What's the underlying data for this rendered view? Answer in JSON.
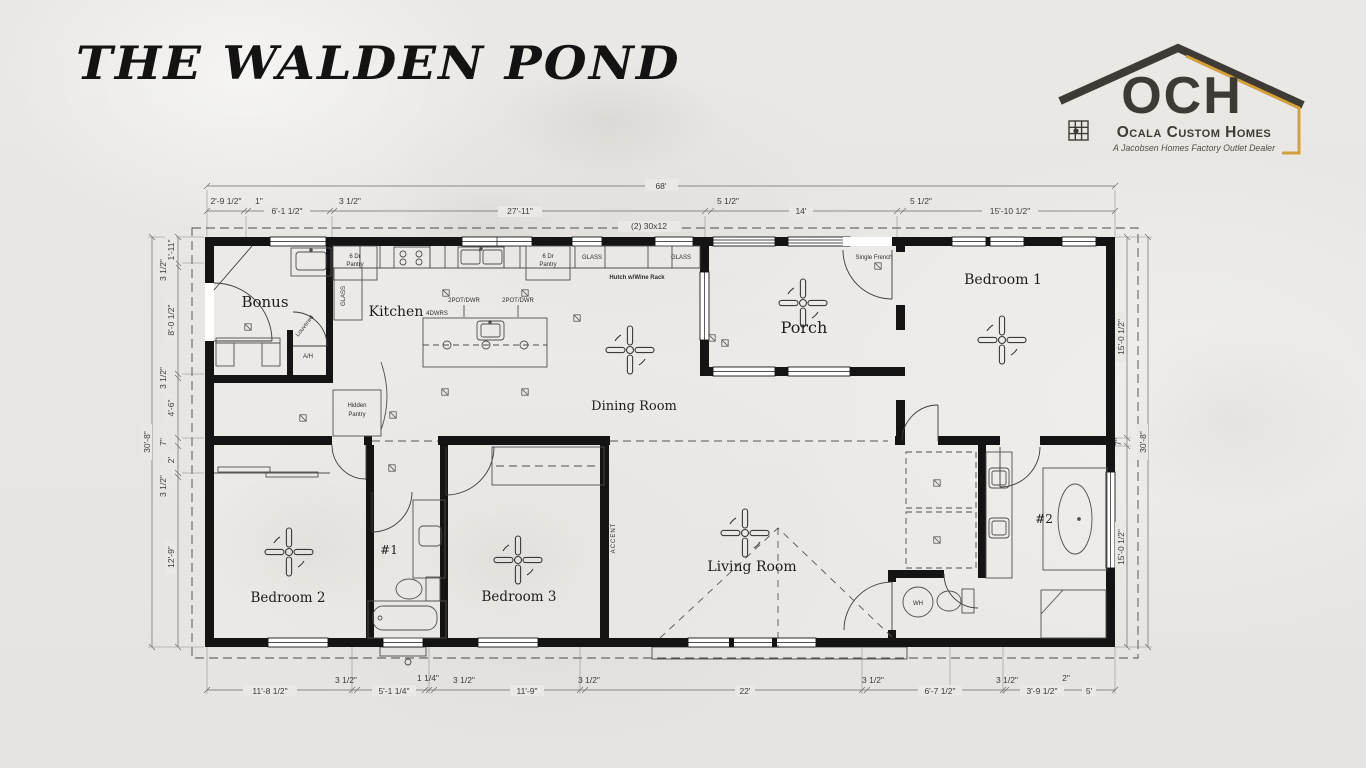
{
  "page": {
    "title": "THE WALDEN POND"
  },
  "logo": {
    "monogram": "OCH",
    "company": "Ocala Custom Homes",
    "tagline": "A Jacobsen Homes Factory Outlet Dealer",
    "colors": {
      "dark": "#3e3b37",
      "gold": "#d3a039"
    }
  },
  "plan": {
    "overall_width": "68'",
    "overall_depth_left": "30'-8\"",
    "overall_depth_right": "30'-8\"",
    "window_note": "(2) 30x12",
    "dims_top": [
      "2'-9 1/2\"",
      "1\"",
      "6'-1 1/2\"",
      "3 1/2\"",
      "27'-11\"",
      "5 1/2\"",
      "14'",
      "5 1/2\"",
      "15'-10 1/2\""
    ],
    "dims_bottom": [
      "11'-8 1/2\"",
      "3 1/2\"",
      "5'-1 1/4\"",
      "1 1/4\"",
      "3 1/2\"",
      "11'-9\"",
      "3 1/2\"",
      "22'",
      "3 1/2\"",
      "6'-7 1/2\"",
      "3 1/2\"",
      "3'-9 1/2\"",
      "2\"",
      "5'"
    ],
    "dims_left": [
      "1'-11\"",
      "3 1/2\"",
      "8'-0 1/2\"",
      "3 1/2\"",
      "4'-6\"",
      "7\"",
      "2'",
      "3 1/2\"",
      "12'-9\""
    ],
    "dims_right": [
      "15'-0 1/2\"",
      "7\"",
      "15'-0 1/2\""
    ],
    "rooms": {
      "bonus": "Bonus",
      "kitchen": "Kitchen",
      "dining": "Dining Room",
      "porch": "Porch",
      "bedroom1": "Bedroom 1",
      "bedroom2": "Bedroom 2",
      "bedroom3": "Bedroom 3",
      "living": "Living Room",
      "bath1": "#1",
      "bath2": "#2"
    },
    "labels": {
      "ah": "A/H",
      "louvered": "Louvered",
      "pantry_line1": "6 Dr",
      "pantry_line2": "Pantry",
      "glass": "GLASS",
      "hutch": "Hutch w/Wine Rack",
      "pot_dwr": "2POT/DWR",
      "dwrs": "4DWRS",
      "hidden_line1": "Hidden",
      "hidden_line2": "Pantry",
      "single_french": "Single French",
      "accent": "ACCENT",
      "wh": "WH"
    }
  }
}
